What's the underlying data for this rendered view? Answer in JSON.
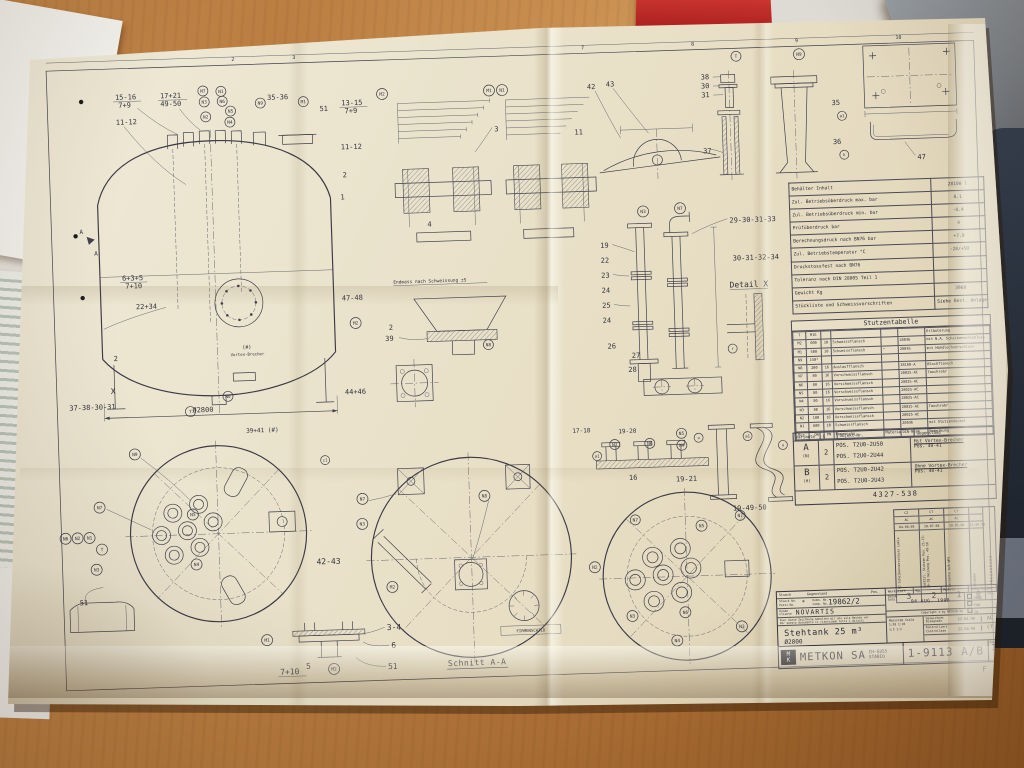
{
  "colors": {
    "paper": "#ebe4ce",
    "ink": "#41414d",
    "wood": "#b5773c",
    "binder_red": "#bf2b2b",
    "navy": "#222c3a"
  },
  "sheet": {
    "grid_numbers": [
      "2",
      "3",
      "7",
      "8",
      "9",
      "10"
    ],
    "corner_letter": "F"
  },
  "callouts": {
    "N1": "N1",
    "N2": "N2",
    "N3": "N3",
    "N4": "N4",
    "N5": "N5",
    "N6": "N6",
    "N7": "N7",
    "N8": "N8",
    "N9": "N9",
    "M1": "M1",
    "M2": "M2",
    "T": "T",
    "c1": "c1",
    "a1": "a1",
    "k": "k",
    "u": "u",
    "r": "r"
  },
  "labels": {
    "b15_16": "15-16",
    "b7_9": "7+9",
    "b17_21": "17+21",
    "b49_50": "49-50",
    "b11_12": "11-12",
    "b35_36": "35-36",
    "b51": "51",
    "b22_34": "22+34",
    "b13_15": "13-15",
    "b6_3_5": "6+3+5",
    "b7_10": "7+10",
    "b1": "1",
    "b2": "2",
    "b3": "3",
    "b4": "4",
    "b5": "5",
    "b6": "6",
    "b11": "11",
    "b16": "16",
    "b19": "19",
    "b22": "22",
    "b23": "23",
    "b24": "24",
    "b25": "25",
    "b26": "26",
    "b27": "27",
    "b28": "28",
    "b30": "30",
    "b31": "31",
    "b35": "35",
    "b36": "36",
    "b37": "37",
    "b38": "38",
    "b39": "39",
    "b42": "42",
    "b43": "43",
    "b47": "47",
    "b3_4": "3-4",
    "b42_43": "42-43",
    "b47_48": "47-48",
    "b44_46": "44+46",
    "b39_41": "39+41 (#)",
    "b37_38_30_31": "37-38-30-31",
    "b29_30_31_33": "29-30-31-33",
    "b30_31_32_34": "30-31-32-34",
    "b17_18": "17-18",
    "b19_20": "19-20",
    "b19_21": "19-21",
    "b19_49_50": "19-49-50",
    "dia2800": "Ø2800",
    "detail_x": "Detail X",
    "x_mark": "X",
    "a_mark": "A",
    "endmass": "Endmass nach Schweissung ±5",
    "vortex_hash": "(#)",
    "vortex": "Vortex-Brecher",
    "firmenschild": "FIRMENSCHILD",
    "schnitt": "Schnitt A-A"
  },
  "spec_table": {
    "rows": [
      [
        "Behälter Inhalt",
        "28100 l"
      ],
      [
        "Zul. Betriebsüberdruck max.  bar",
        "0.1"
      ],
      [
        "Zul. Betriebsüberdruck min.  bar",
        "-0.4"
      ],
      [
        "Prüfüberdruck  bar",
        "4"
      ],
      [
        "Berechnungsdruck nach BN76  bar",
        "+7.8"
      ],
      [
        "Zul. Betriebstemperatur  °C",
        "-20/+50"
      ],
      [
        "Druckstossfest nach BN76",
        ""
      ],
      [
        "Toleranz nach DIN 28005 Teil 1",
        ""
      ],
      [
        "Gewicht  Kg",
        "3960"
      ],
      [
        "Stückliste und Schweissvorschriften",
        "Siehe Best. Anlage"
      ]
    ]
  },
  "stutzentabelle": {
    "title": "Stutzentabelle",
    "rows": [
      [
        "T",
        "M16",
        "",
        "",
        "",
        "",
        "Erläuterung"
      ],
      [
        "M2",
        "600",
        "10",
        "Schweissflansch",
        "",
        "28036",
        "mit N.A. Scheibenverschluss"
      ],
      [
        "M1",
        "500",
        "10",
        "Schweissflansch",
        "\"",
        "28036",
        "mit Handlochverschluss"
      ],
      [
        "N9",
        "150*",
        "",
        "",
        "",
        "",
        ""
      ],
      [
        "N8",
        "200",
        "16",
        "Auslaufflansch",
        "",
        "28160-A",
        "Blockflansch"
      ],
      [
        "N7",
        "80",
        "16",
        "Vorschweissflansch",
        "",
        "28025-AC",
        "Tauchrohr"
      ],
      [
        "N6",
        "80",
        "16",
        "Vorschweissflansch",
        "",
        "28025-AC",
        ""
      ],
      [
        "N5",
        "80",
        "16",
        "Vorschweissflansch",
        "",
        "28025-AC",
        ""
      ],
      [
        "N4",
        "80",
        "16",
        "Vorschweissflansch",
        "",
        "28025-AC",
        ""
      ],
      [
        "N3",
        "80",
        "16",
        "Vorschweissflansch",
        "",
        "28025-AC",
        "Tauchrohr"
      ],
      [
        "N2",
        "100",
        "16",
        "Vorschweissflansch",
        "",
        "28025-AC",
        ""
      ],
      [
        "N1",
        "600",
        "10",
        "Schweissflansch",
        "",
        "28036",
        "mit Stutzendeckel"
      ],
      [
        "Bez.",
        "DN",
        "PN",
        "Benennung",
        "Material",
        "DIN-Norm",
        "Bemerkung"
      ]
    ]
  },
  "variant_table": {
    "headers": [
      "Variante",
      "X",
      "Objekt-Nr.",
      "Gegenstand"
    ],
    "rows": [
      {
        "variant": "A",
        "variant_sub": "(N)",
        "qty": "2",
        "pos1": "POS. T2U0-2U50",
        "pos2": "POS. T2U0-2U44",
        "subject": "Mit Vortex-Brecher",
        "subject_sub": "Pos. 40-41"
      },
      {
        "variant": "B",
        "variant_sub": "(H)",
        "qty": "2",
        "pos1": "POS. T2U0-2U42",
        "pos2": "POS. T2U0-2U43",
        "subject": "Ohne Vortex-Brecher",
        "subject_sub": "Pos. 40-41"
      }
    ],
    "code_number": "4327-538"
  },
  "revisions": {
    "heading_side": "ÄNDERUNGEN",
    "rev_label": "Rev.",
    "cols": [
      {
        "sig1": "CZ",
        "sig2": "AC",
        "date": "04.08.98",
        "text": "N2 Scheibenverschluss Lakis",
        "num": "3"
      },
      {
        "sig1": "CT",
        "sig2": "AC",
        "date": "10.07.98",
        "text": "Zusätzl. Stutzen Pos. 21-23-26-28 Heizung Pos. 49-50",
        "num": "2"
      },
      {
        "sig1": "CT",
        "sig2": "AC",
        "date": "19.05.98",
        "text": "Variante A/B WPS",
        "num": "1"
      },
      {
        "sig1": "",
        "sig2": "",
        "date": "22.04.98",
        "text": "Ausgabe",
        "num": "0"
      }
    ]
  },
  "title_block": {
    "stueck_label": "Stueck",
    "gegenstand_label": "Gegenstand",
    "pos_label": "Pos.",
    "stueck_no_label": "Stueck No.",
    "pezzi_no_label": "Pezzi No.",
    "stueck_no_value": "*",
    "komm_label": "Komm. No.",
    "comm_label": "Comm. No.",
    "komm_value": "19862/2",
    "kunde_label": "Kunde",
    "cliente_label": "Cliente",
    "kunde_value": "NOVARTIS",
    "legal_line1": "Fuer diese Zeichnung behalten wir uns alle Rechte vor",
    "legal_line2": "Per questo documento ci riserviamo tutti i diritti",
    "object_title": "Stehtank 25 m³",
    "object_diameter": "Ø2800",
    "logo_m": "M",
    "logo_k": "K",
    "company": "METKON SA",
    "company_location": "CH-6855 STABIO",
    "werkstoff_label": "Werkstoff",
    "kg_label": "Kg.",
    "modell_label": "Modell",
    "bemerkungen_label": "Bemerkungen",
    "datum_label": "Datum",
    "data_label": "Data",
    "date_stamp": "04 AUG. 1998",
    "checkbox_labels": [
      "PROD",
      "FAB",
      "CQ"
    ],
    "copyright": "Copyright © by METKON SA",
    "massstab_label": "Massstab",
    "scala_label": "Scala",
    "scales": [
      "1:20",
      "1:10",
      "1:5",
      "1:2"
    ],
    "drawn_label": "Gezeichnet",
    "drawn_label2": "Disegnato",
    "drawn_date": "22.04.98",
    "drawn_by": "AC",
    "checked_label": "Kontrolliert",
    "checked_label2": "Controllato",
    "checked_date": "22.04.98",
    "checked_by": "CT",
    "drawing_number": "1-9113 A/B",
    "rev_label": "Rev.",
    "rev_value": "3"
  }
}
